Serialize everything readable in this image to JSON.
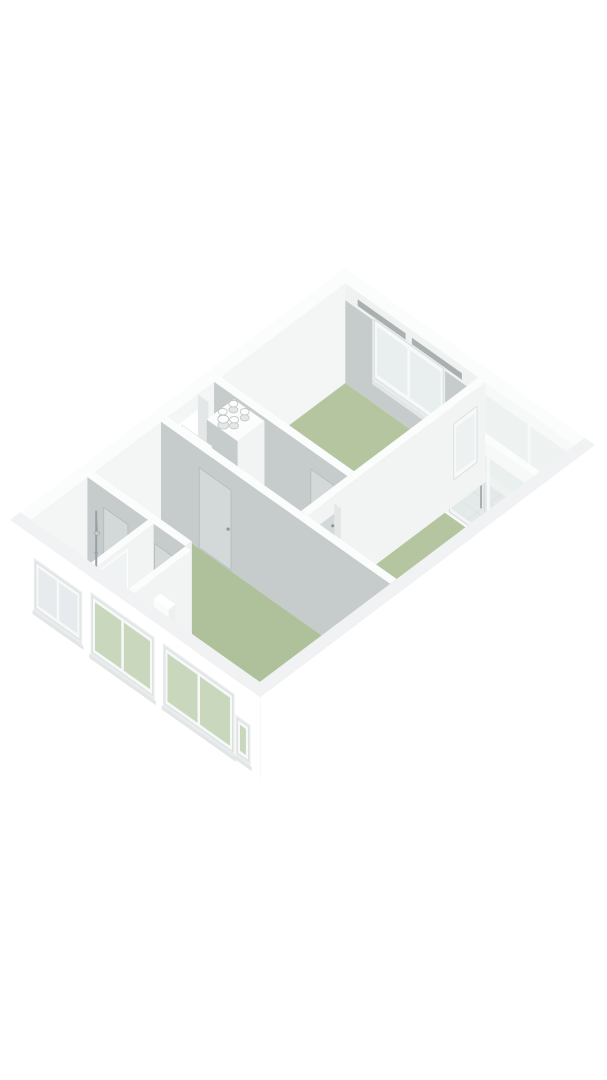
{
  "scene": {
    "type": "isometric-3d-floorplan",
    "background": "#ffffff",
    "wall_height_px": 100
  },
  "colors": {
    "bg": "#ffffff",
    "floorGreen1": "#b4c5a0",
    "floorGreen2": "#aec19b",
    "floorBlue": "#9fb2c8",
    "floorHall": "#eceeee",
    "floorTile": "#e3e6e6",
    "tileLine": "#d3d7d7",
    "wallTop": "#fbfcfc",
    "wallWhite": "#f2f3f3",
    "wallGray": "#c6cbcb",
    "nwInner": "#f4f5f5",
    "capX": "#eff1f1",
    "jamb": "#e4e7e7",
    "ext": "#ffffff",
    "extTop": "#f1f2f3",
    "frame": "#f7f8f8",
    "frameLine": "#d9dddd",
    "glassSky": "#e9eeee",
    "glassGreen": "#c9d7bd",
    "glassFrost": "#e7ebed",
    "glassPale": "#e6edec",
    "vent": "#aab0b0",
    "metal": "#9aa1a6",
    "doorPanel": "#d3d8d8",
    "panelLine": "#b4baba",
    "handle": "#8f9696",
    "doorWhite": "#ffffff",
    "doorLine": "#e2e5e5",
    "pipeTop": "#fdfdfd",
    "pipeSide": "#e4e7e7",
    "pipeLine": "#c2c6c6",
    "sill": "#e3e6e6",
    "reveal": "#e9ecec",
    "band": "#f0f1f1"
  },
  "rooms": [
    {
      "id": "bedroom-1",
      "floor": "floorGreen1",
      "rect": [
        0.25,
        0.25,
        3.45,
        3.3
      ]
    },
    {
      "id": "balcony",
      "floor": "floorTile",
      "rect": [
        3.61,
        0.25,
        5.75,
        1.1
      ]
    },
    {
      "id": "bedroom-2",
      "floor": "floorGreen1",
      "rect": [
        3.61,
        1.24,
        5.75,
        4.6
      ]
    },
    {
      "id": "hallway",
      "floor": "floorHall",
      "rect": [
        0.25,
        3.46,
        3.45,
        4.6
      ]
    },
    {
      "id": "living-room",
      "floor": "floorGreen2",
      "rect": [
        0.25,
        4.76,
        5.75,
        7.95
      ]
    },
    {
      "id": "bathroom",
      "floor": "floorBlue",
      "rect": [
        0.25,
        6.56,
        1.7,
        7.95
      ]
    },
    {
      "id": "toilet",
      "floor": "floorBlue",
      "rect": [
        1.84,
        6.56,
        2.6,
        7.95
      ]
    }
  ],
  "features": {
    "duct_pipes": 5,
    "shower": true,
    "toilet_fixture": true,
    "front_door_open": true,
    "balcony_glazed": true,
    "ne_window": 1,
    "sw_windows": 4,
    "interior_window": 1,
    "vent_slots": 2
  }
}
